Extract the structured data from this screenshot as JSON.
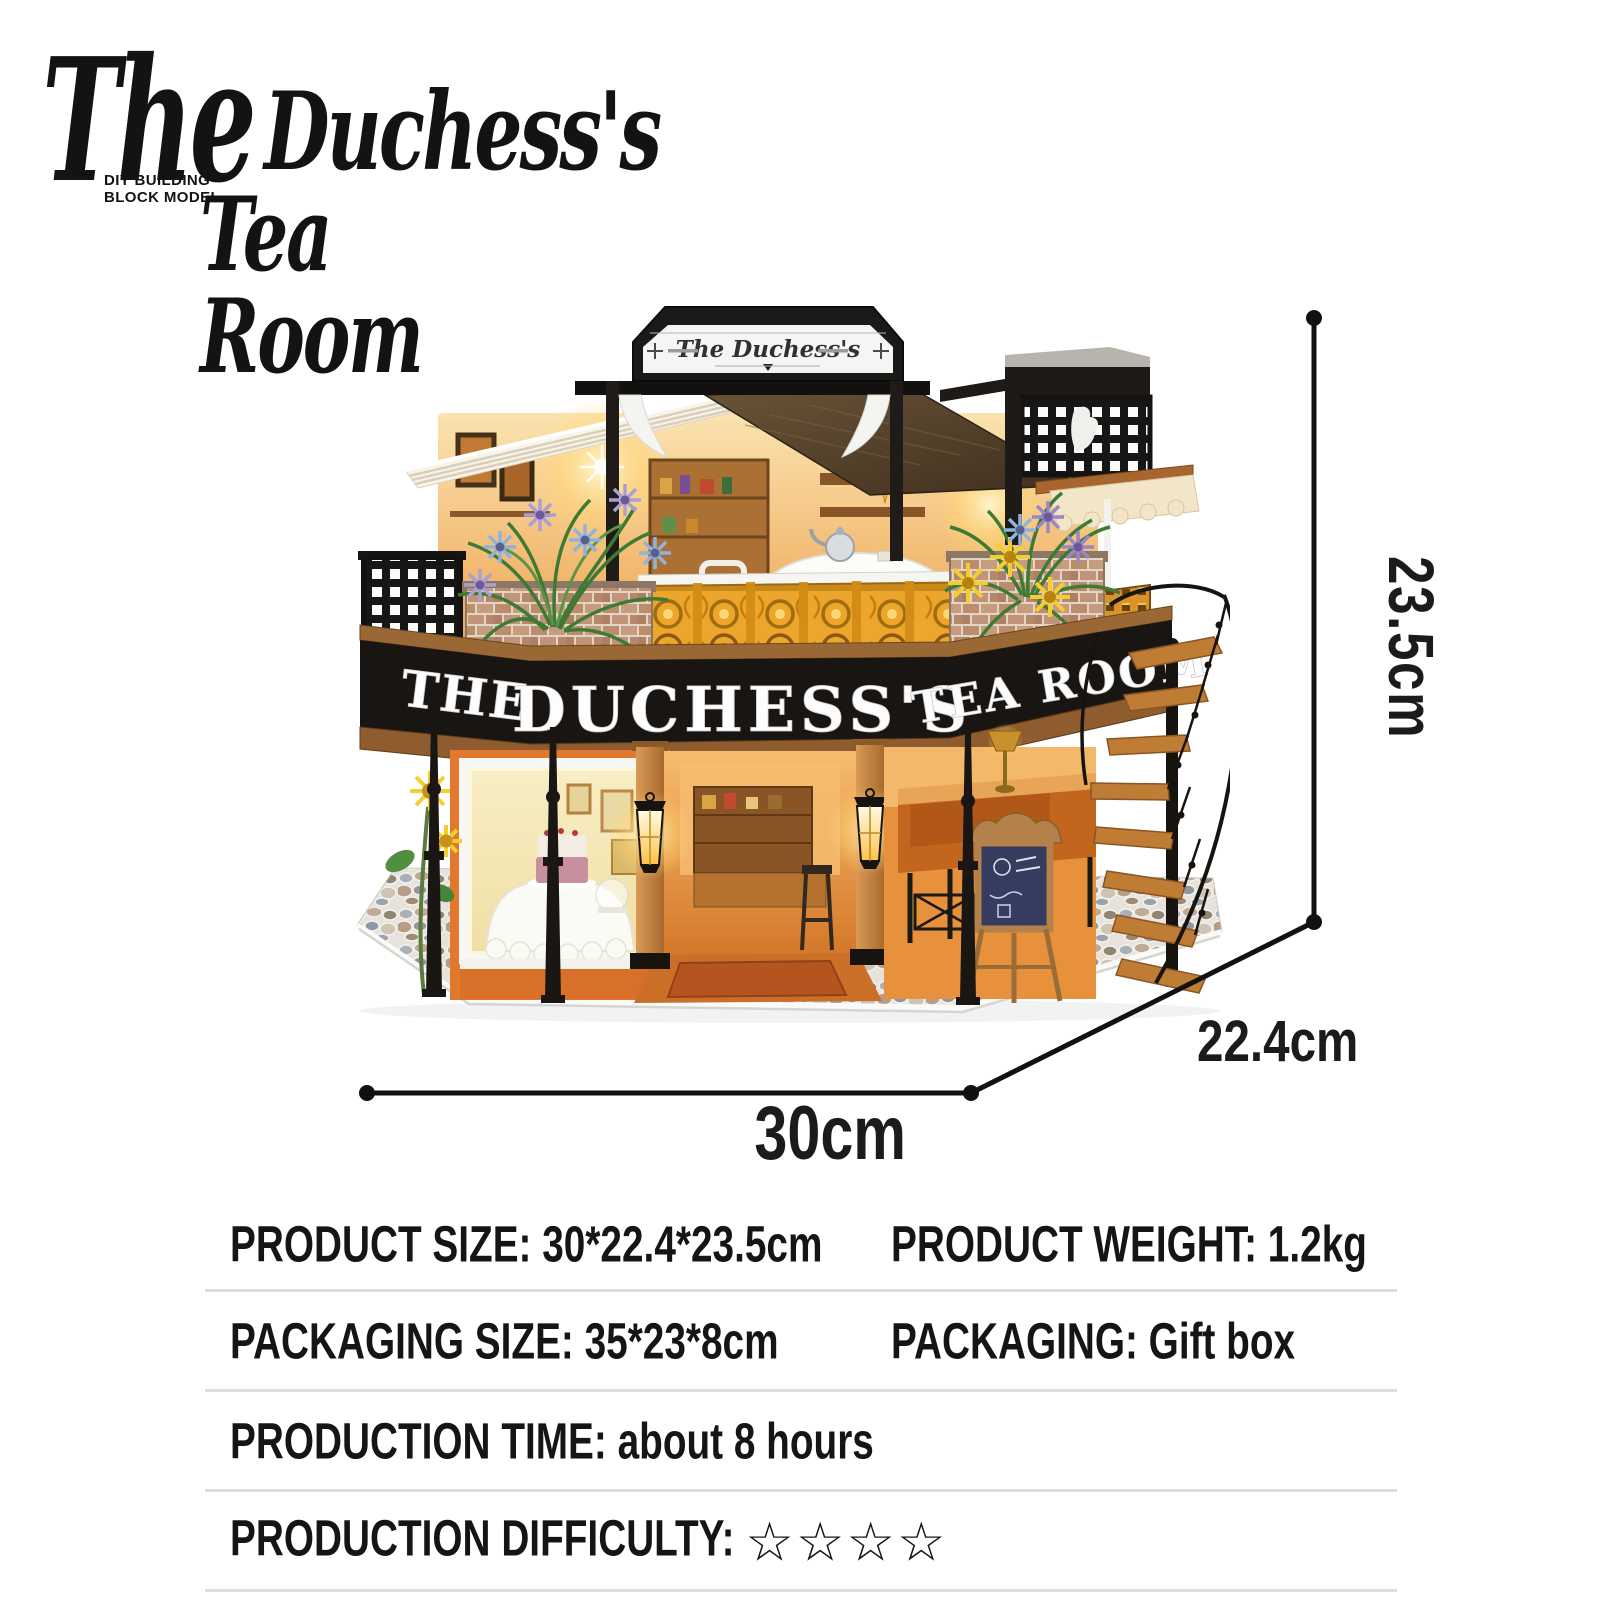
{
  "logo": {
    "script_the": "The",
    "script_rest": "Duchess's",
    "line2": "Tea Room",
    "tag_line1": "DIY BUILDING",
    "tag_line2": "BLOCK MODEL"
  },
  "model": {
    "top_sign": "The Duchess's",
    "fascia_left": "THE",
    "fascia_center": "DUCHESS'S",
    "fascia_right": "TEA ROOM"
  },
  "dimensions": {
    "height": "23.5cm",
    "depth": "22.4cm",
    "width": "30cm"
  },
  "specs": {
    "rows": [
      {
        "left": "PRODUCT SIZE: 30*22.4*23.5cm",
        "right": "PRODUCT WEIGHT: 1.2kg"
      },
      {
        "left": "PACKAGING SIZE: 35*23*8cm",
        "right": "PACKAGING: Gift box"
      },
      {
        "left": "PRODUCTION TIME: about 8 hours",
        "right": ""
      },
      {
        "left": "PRODUCTION DIFFICULTY:",
        "right": "",
        "stars": "☆☆☆☆"
      }
    ]
  },
  "colors": {
    "text": "#151515",
    "divider": "#dedede",
    "annotation": "#111111",
    "fascia_black": "#191512",
    "wood_trim": "#9a6835",
    "gold_railing": "#eca62b",
    "warm_glow": "#ffd978",
    "awning_cream": "#f3e5c7",
    "brick": "#bc8d6d",
    "cobble": "#e7e3dc"
  }
}
